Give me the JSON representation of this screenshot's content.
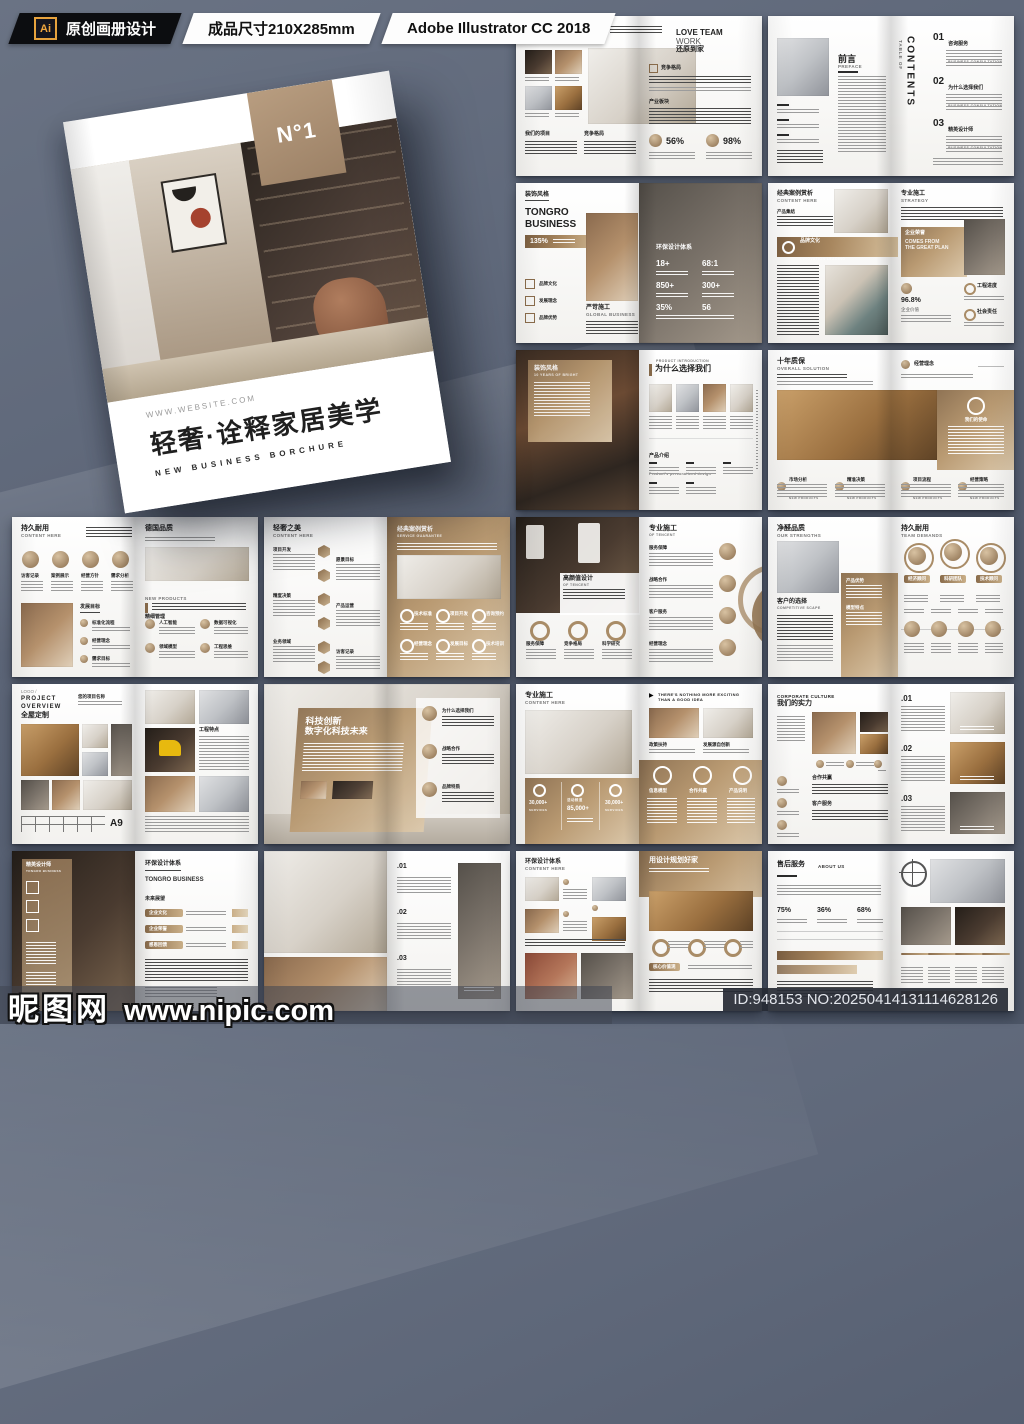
{
  "top_bar": {
    "ai_icon": "Ai",
    "tag": "原创画册设计",
    "size": "成品尺寸210X285mm",
    "software": "Adobe Illustrator CC 2018"
  },
  "cover": {
    "badge": "N°1",
    "website": "WWW.WEBSITE.COM",
    "title": "轻奢·诠释家居美学",
    "subtitle": "NEW BUSINESS BORCHURE"
  },
  "footer": {
    "brand": "昵图网",
    "url": "www.nipic.com",
    "id_text": "ID:948153 NO:20250414131114628126"
  },
  "accent_color": "#a8875f",
  "spreads": {
    "s1": {
      "left_title": "全屋尊享",
      "left_sub": "OUR ADVANTAGES",
      "sec1": "我们的项目",
      "sec2": "竞争格局",
      "rt1": "LOVE TEAM",
      "rt2": "WORK",
      "rt3": "还原到家",
      "rsec1": "竞争格局",
      "rsec2": "产业板块",
      "stat1": "56%",
      "stat2": "98%"
    },
    "s2": {
      "title": "前言",
      "sub": "PREFACE",
      "toc": "CONTENTS",
      "toc_sub": "TABLE OF",
      "n1": "01",
      "t1": "咨询服务",
      "n2": "02",
      "t2": "为什么选择我们",
      "n3": "03",
      "t3": "精英设计师",
      "te": "BUSINESS CONSULTATION"
    },
    "s3": {
      "tag": "装饰风格",
      "t1": "TONGRO",
      "t2": "BUSINESS",
      "stat": "135%",
      "i1": "品牌文化",
      "i2": "发展理念",
      "i3": "品牌优势",
      "sec": "严苛施工",
      "sec_en": "GLOBAL BUSINESS",
      "ov": "环保设计体系",
      "p1": "18+",
      "p2": "68:1",
      "p3": "850+",
      "p4": "300+",
      "p5": "35%",
      "p6": "56"
    },
    "s4": {
      "lt": "经典案例赏析",
      "ls": "CONTENT HERE",
      "line": "产品集结",
      "band": "品牌文化",
      "band_en": "INNOVATION LEADING",
      "rt": "专业施工",
      "rs": "STRATEGY",
      "bx1": "企业荣誉",
      "bx2": "COMES FROM",
      "bx3": "THE GREAT PLAN",
      "pct": "96.8%",
      "pctl": "企业价值",
      "r1": "工程进度",
      "r2": "社会责任"
    },
    "s5": {
      "card": "装饰风格",
      "card_en": "10 YEARS OF BRIGHT",
      "kick": "PRODUCT INTRODUCTION",
      "rt": "为什么选择我们",
      "sec": "产品介绍",
      "sec_en": "Product's personalized design"
    },
    "s6": {
      "lt": "十年质保",
      "ls": "OVERALL SOLUTION",
      "rh": "经营理念",
      "panel": "我们的使命",
      "c1": "市场分析",
      "c2": "精准决策",
      "c3": "项目流程",
      "c4": "经营策略",
      "ce": "NEW PRODUCTS"
    },
    "s7": {
      "lt": "持久耐用",
      "ls": "CONTENT HERE",
      "a1": "访客记录",
      "a2": "案例展示",
      "a3": "经营方针",
      "a4": "需求分析",
      "goal": "发展目标",
      "g1": "标准化流程",
      "g2": "经营理念",
      "g3": "需求目标",
      "rt": "德国品质",
      "rk": "NEW PRODUCTS",
      "rsec": "精细管理",
      "r1": "人工智能",
      "r2": "数据可视化",
      "r3": "领域模型",
      "r4": "工程思维"
    },
    "s8": {
      "lt": "轻奢之美",
      "ls": "CONTENT HERE",
      "h1": "项目开发",
      "h2": "愿景目标",
      "h3": "精度决策",
      "h4": "产品运营",
      "h5": "业务领域",
      "h6": "访客记录",
      "rt": "经典案例赏析",
      "rs": "SERVICE GUARANTEE",
      "st1": "技术标准",
      "st2": "项目开发",
      "st3": "咨询预约",
      "st4": "经营理念",
      "st5": "发展目标",
      "st6": "技术培训"
    },
    "s9": {
      "ot": "高颜值设计",
      "os": "OF TENCENT",
      "d1": "服务保障",
      "d2": "竞争格局",
      "d3": "科学研究",
      "rt": "专业施工",
      "rs": "OF TENCENT",
      "r1": "服务保障",
      "r2": "战略合作",
      "r3": "客户服务",
      "r4": "经营理念"
    },
    "s10": {
      "lt": "净醛品质",
      "ls": "OUR STRENGTHS",
      "sec": "客户的选择",
      "sec_en": "COMPETITIVE SCAPE",
      "pa1": "产品优势",
      "pa2": "模型特点",
      "rt": "持久耐用",
      "rs": "TEAM DEMANDS",
      "p1": "经济顾问",
      "p2": "科研团队",
      "p3": "技术顾问"
    },
    "s11": {
      "logo": "LOGO /",
      "t1": "PROJECT",
      "t2": "OVERVIEW",
      "t3": "全屋定制",
      "hr": "您的项目名称",
      "grade": "A9",
      "rsec": "工程特点"
    },
    "s12": {
      "t1": "科技创新",
      "t2": "数字化科技未来",
      "c1": "为什么选择我们",
      "c2": "战略合作",
      "c3": "品牌特质"
    },
    "s13": {
      "lt": "专业施工",
      "ls": "CONTENT HERE",
      "s1": "30,000+",
      "s1e": "SERVICES",
      "s2a": "活动频道",
      "s2": "85,000+",
      "s3": "30,000+",
      "s3e": "SERVICES",
      "play": "▶",
      "k1": "THERE'S NOTHING MORE EXCITING",
      "k2": "THAN A GOOD IDEA",
      "ph1": "政策扶持",
      "ph2": "发展源自创新",
      "c1": "信息模型",
      "c2": "合作共赢",
      "c3": "产品说明"
    },
    "s14": {
      "kick": "CORPORATE CULTURE",
      "t": "我们的实力",
      "sec1": "合作共赢",
      "sec2": "客户服务",
      "n1": ".01",
      "n2": ".02",
      "n3": ".03"
    },
    "s15": {
      "st": "精英设计师",
      "ss": "TONGRO BUSINESS",
      "rt": "环保设计体系",
      "rs": "TONGRO BUSINESS",
      "sec": "未来展望",
      "p1": "企业文化",
      "p2": "企业荣誉",
      "p3": "感恩回馈"
    },
    "s16": {
      "n1": ".01",
      "n2": ".02",
      "n3": ".03"
    },
    "s17": {
      "lt": "环保设计体系",
      "ls": "CONTENT HERE",
      "rt": "用设计规划好家",
      "pill": "核心价值观"
    },
    "s18": {
      "lt": "售后服务",
      "ls": "ABOUT US",
      "st1": "75%",
      "st2": "36%",
      "st3": "68%"
    }
  }
}
